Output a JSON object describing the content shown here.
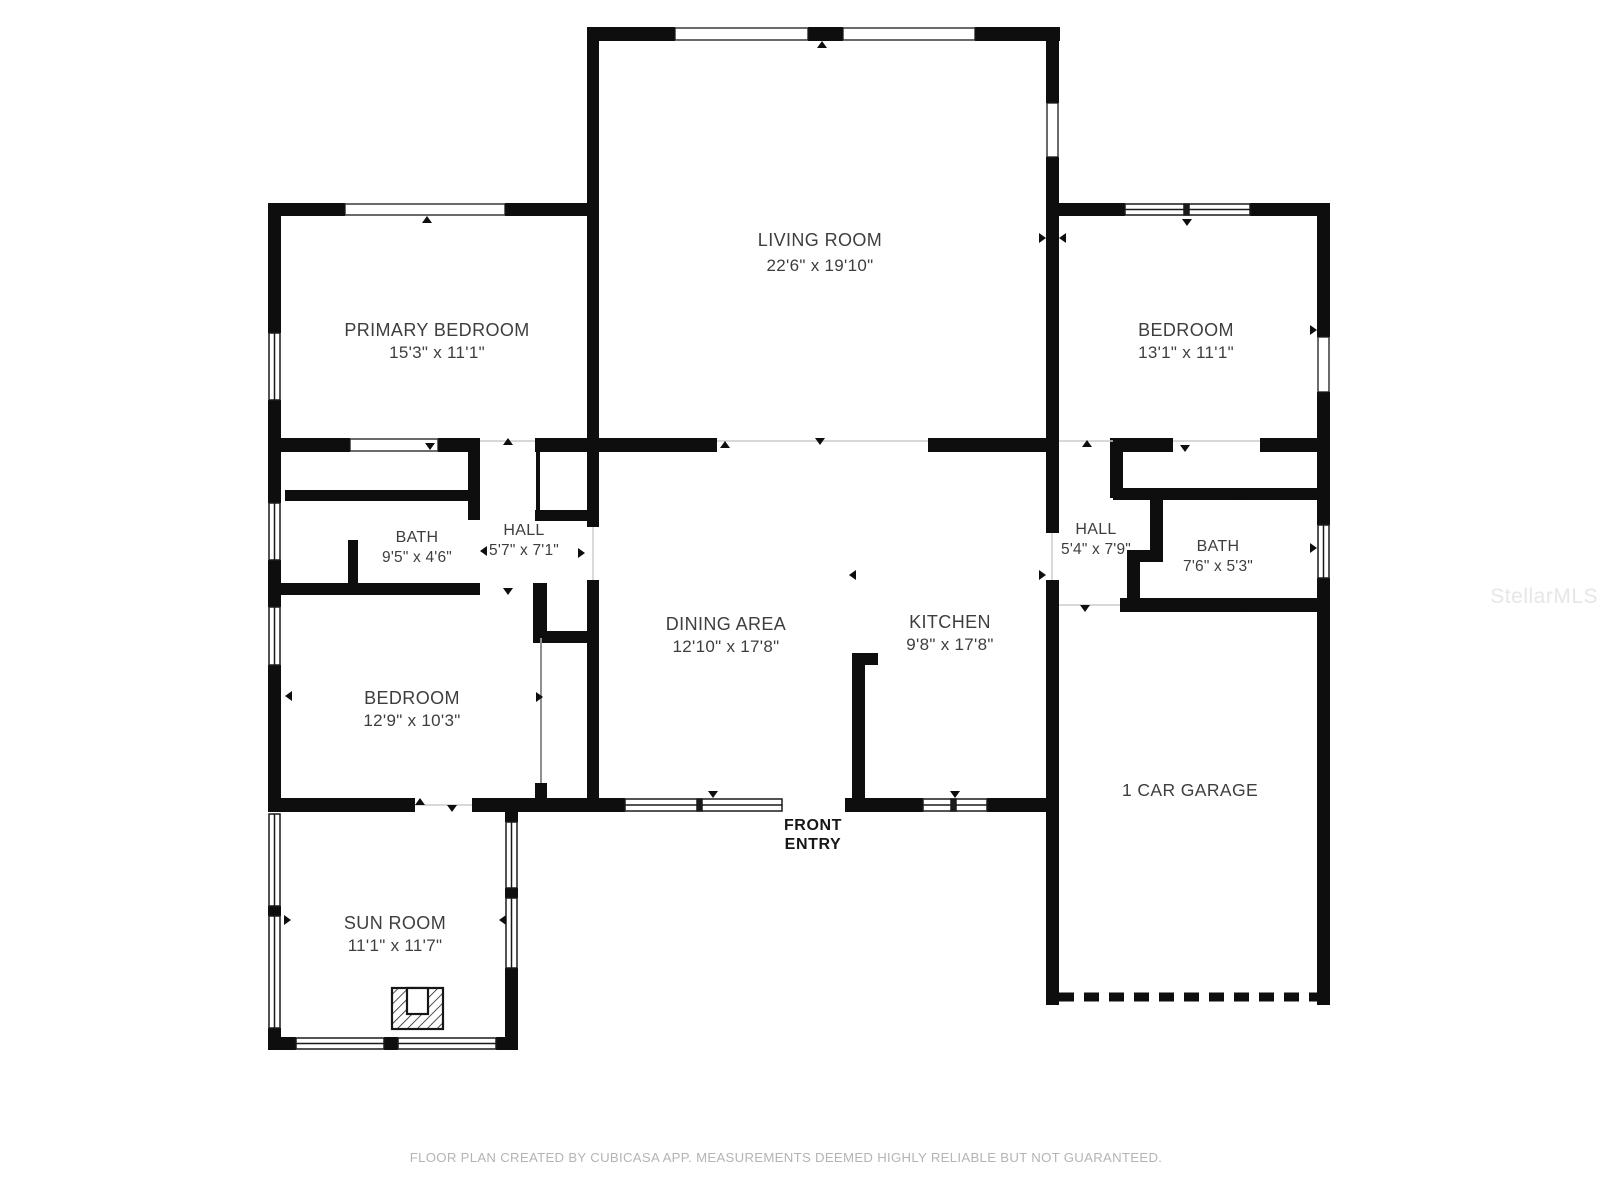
{
  "colors": {
    "wall": "#0e0e0e",
    "label": "#3e3e3e",
    "entry": "#161616",
    "footer": "#b4b4b4",
    "watermark": "#e6e6e6",
    "opening_line": "#cccccc",
    "background": "#ffffff"
  },
  "rooms": {
    "living_room": {
      "name": "LIVING ROOM",
      "dims": "22'6\" x 19'10\""
    },
    "primary_bedroom": {
      "name": "PRIMARY BEDROOM",
      "dims": "15'3\" x 11'1\""
    },
    "bedroom_right": {
      "name": "BEDROOM",
      "dims": "13'1\" x 11'1\""
    },
    "bedroom_left": {
      "name": "BEDROOM",
      "dims": "12'9\" x 10'3\""
    },
    "bath_left": {
      "name": "BATH",
      "dims": "9'5\" x 4'6\""
    },
    "hall_left": {
      "name": "HALL",
      "dims": "5'7\" x 7'1\""
    },
    "hall_right": {
      "name": "HALL",
      "dims": "5'4\" x 7'9\""
    },
    "bath_right": {
      "name": "BATH",
      "dims": "7'6\" x 5'3\""
    },
    "dining_area": {
      "name": "DINING AREA",
      "dims": "12'10\" x 17'8\""
    },
    "kitchen": {
      "name": "KITCHEN",
      "dims": "9'8\" x 17'8\""
    },
    "sun_room": {
      "name": "SUN ROOM",
      "dims": "11'1\" x 11'7\""
    },
    "garage": {
      "name": "1 CAR GARAGE"
    }
  },
  "front_entry": {
    "line1": "FRONT",
    "line2": "ENTRY"
  },
  "footer": "FLOOR PLAN CREATED BY CUBICASA APP. MEASUREMENTS DEEMED HIGHLY RELIABLE BUT NOT GUARANTEED.",
  "watermark": "StellarMLS"
}
